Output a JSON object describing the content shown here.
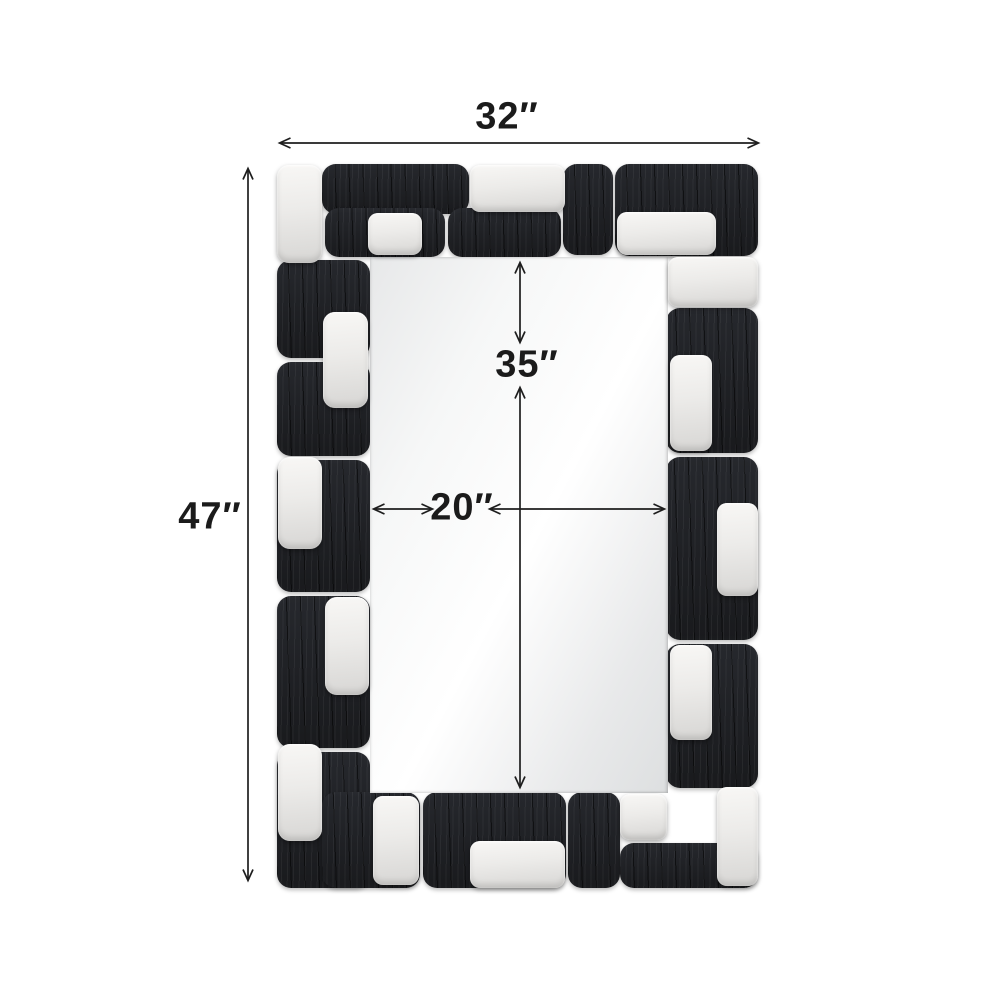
{
  "diagram": {
    "type": "product-dimension-diagram",
    "subject": "geometric black and silver rectangular wall mirror",
    "background_color": "#ffffff",
    "dimension_labels": {
      "overall_width": "32″",
      "overall_height": "47″",
      "mirror_height": "35″",
      "mirror_width": "20″"
    },
    "colors": {
      "frame_black": "#1e2024",
      "block_silver": "#ecebe9",
      "mirror_glass": "#f4f5f5",
      "dimension_line": "#1e1e1e",
      "label_text": "#1b1b1b"
    }
  },
  "frame": {
    "outer_bounds": {
      "x": 277,
      "y": 163,
      "w": 481,
      "h": 725
    },
    "mirror": {
      "x": 370,
      "y": 257,
      "w": 298,
      "h": 536
    },
    "black_blocks": [
      {
        "x": 322,
        "y": 164,
        "w": 147,
        "h": 50
      },
      {
        "x": 563,
        "y": 164,
        "w": 50,
        "h": 91
      },
      {
        "x": 615,
        "y": 164,
        "w": 143,
        "h": 92
      },
      {
        "x": 325,
        "y": 208,
        "w": 120,
        "h": 49
      },
      {
        "x": 448,
        "y": 208,
        "w": 113,
        "h": 49
      },
      {
        "x": 277,
        "y": 260,
        "w": 93,
        "h": 98
      },
      {
        "x": 277,
        "y": 362,
        "w": 93,
        "h": 94
      },
      {
        "x": 277,
        "y": 460,
        "w": 93,
        "h": 132
      },
      {
        "x": 277,
        "y": 596,
        "w": 93,
        "h": 152
      },
      {
        "x": 277,
        "y": 752,
        "w": 93,
        "h": 136
      },
      {
        "x": 666,
        "y": 308,
        "w": 92,
        "h": 145
      },
      {
        "x": 666,
        "y": 457,
        "w": 92,
        "h": 183
      },
      {
        "x": 666,
        "y": 644,
        "w": 92,
        "h": 144
      },
      {
        "x": 322,
        "y": 792,
        "w": 98,
        "h": 96
      },
      {
        "x": 423,
        "y": 792,
        "w": 143,
        "h": 96
      },
      {
        "x": 568,
        "y": 792,
        "w": 52,
        "h": 96
      },
      {
        "x": 620,
        "y": 843,
        "w": 138,
        "h": 45
      }
    ],
    "white_blocks": [
      {
        "x": 277,
        "y": 165,
        "w": 45,
        "h": 98,
        "r": 12
      },
      {
        "x": 368,
        "y": 213,
        "w": 54,
        "h": 42,
        "r": 10
      },
      {
        "x": 470,
        "y": 165,
        "w": 95,
        "h": 47,
        "r": 10
      },
      {
        "x": 617,
        "y": 212,
        "w": 99,
        "h": 43,
        "r": 10
      },
      {
        "x": 668,
        "y": 257,
        "w": 90,
        "h": 50,
        "r": 10
      },
      {
        "x": 323,
        "y": 312,
        "w": 45,
        "h": 96,
        "r": 12
      },
      {
        "x": 278,
        "y": 457,
        "w": 44,
        "h": 92,
        "r": 12
      },
      {
        "x": 670,
        "y": 355,
        "w": 42,
        "h": 96,
        "r": 10
      },
      {
        "x": 717,
        "y": 503,
        "w": 41,
        "h": 93,
        "r": 10
      },
      {
        "x": 325,
        "y": 597,
        "w": 44,
        "h": 98,
        "r": 12
      },
      {
        "x": 670,
        "y": 645,
        "w": 42,
        "h": 95,
        "r": 10
      },
      {
        "x": 278,
        "y": 744,
        "w": 44,
        "h": 97,
        "r": 12
      },
      {
        "x": 373,
        "y": 796,
        "w": 46,
        "h": 89,
        "r": 10
      },
      {
        "x": 470,
        "y": 841,
        "w": 95,
        "h": 47,
        "r": 10
      },
      {
        "x": 620,
        "y": 794,
        "w": 47,
        "h": 46,
        "r": 10
      },
      {
        "x": 717,
        "y": 787,
        "w": 41,
        "h": 99,
        "r": 10
      }
    ]
  }
}
